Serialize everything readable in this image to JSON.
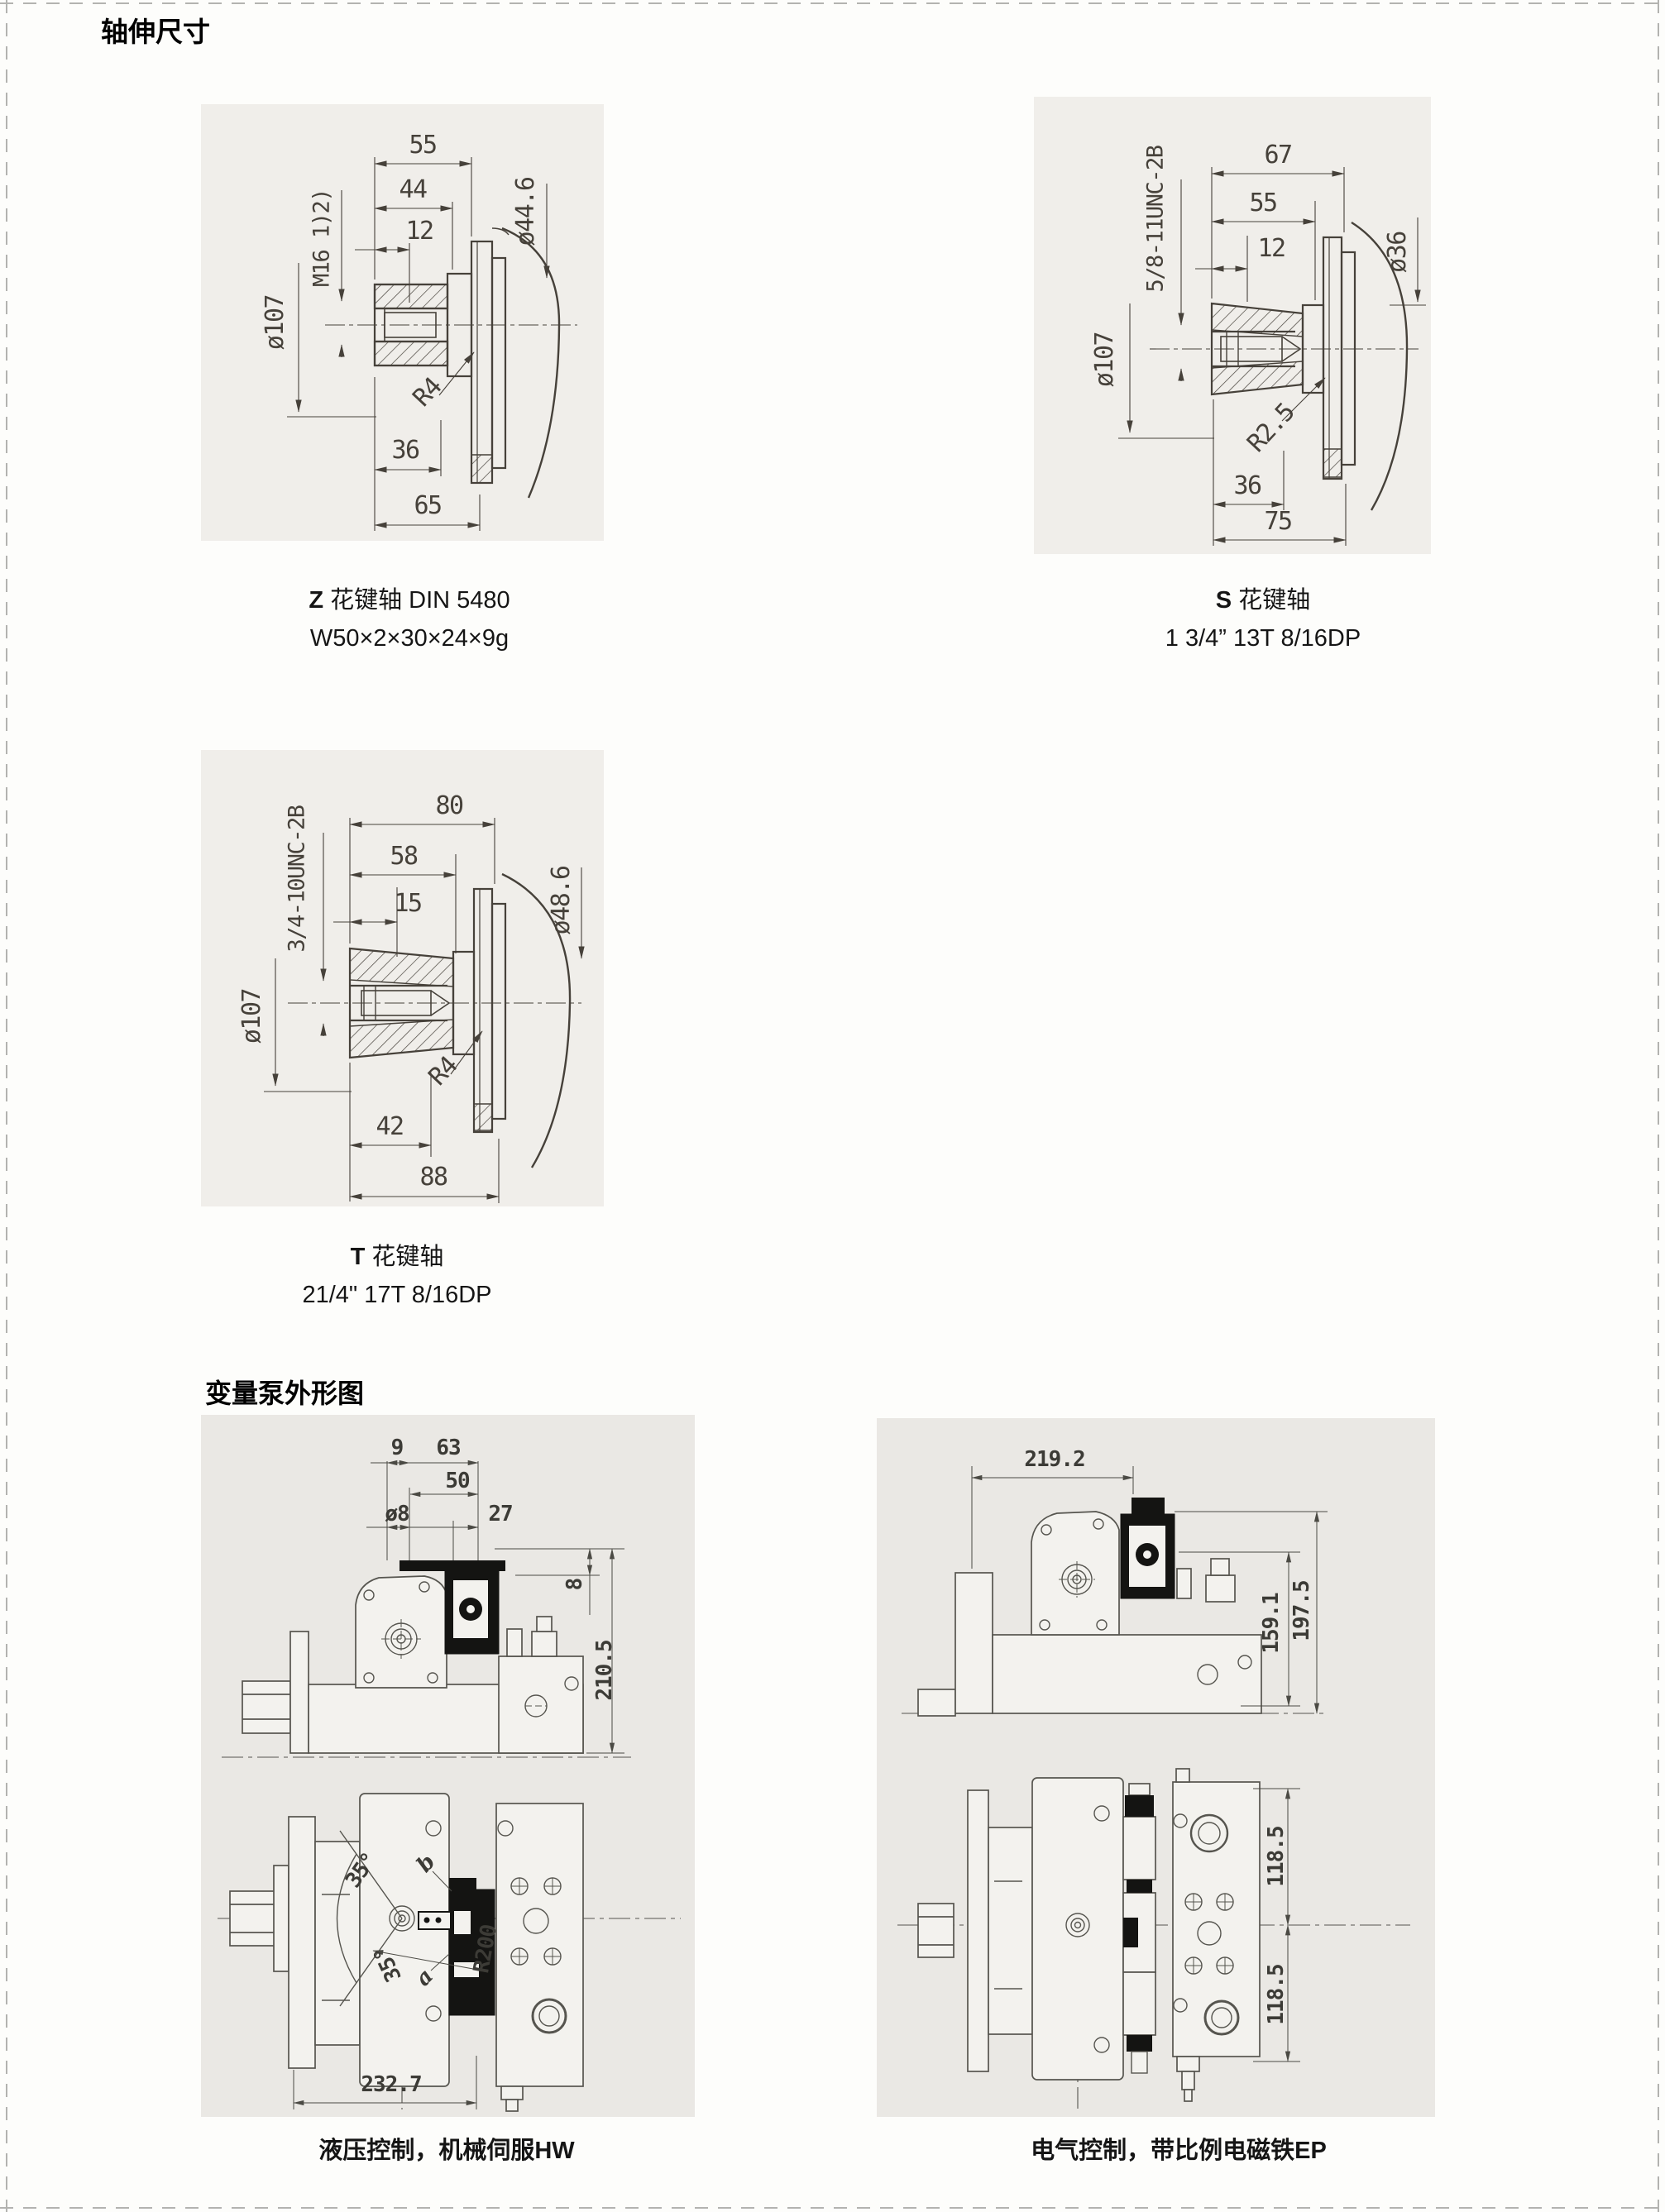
{
  "page": {
    "title": "轴伸尺寸",
    "section_pumps_title": "变量泵外形图"
  },
  "shaft_z": {
    "caption_prefix": "Z",
    "caption_name": "花键轴 DIN 5480",
    "caption_spec": "W50×2×30×24×9g",
    "dims": {
      "d55": "55",
      "d44": "44",
      "d12": "12",
      "thread": "M16 1)2)",
      "dia_right": "ø44.6",
      "dia_left": "ø107",
      "radius": "R4",
      "d36": "36",
      "d65": "65"
    }
  },
  "shaft_s": {
    "caption_prefix": "S",
    "caption_name": "花键轴",
    "caption_spec": "1 3/4”  13T 8/16DP",
    "dims": {
      "d67": "67",
      "d55": "55",
      "d12": "12",
      "thread": "5/8-11UNC-2B",
      "dia_right": "ø36",
      "dia_left": "ø107",
      "radius": "R2.5",
      "d36": "36",
      "d75": "75"
    }
  },
  "shaft_t": {
    "caption_prefix": "T",
    "caption_name": "花键轴",
    "caption_spec": "21/4\"  17T 8/16DP",
    "dims": {
      "d80": "80",
      "d58": "58",
      "d15": "15",
      "thread": "3/4-10UNC-2B",
      "dia_right": "ø48.6",
      "dia_left": "ø107",
      "radius": "R4",
      "d42": "42",
      "d88": "88"
    }
  },
  "pump_hw": {
    "caption": "液压控制，机械伺服HW",
    "dims": {
      "d9": "9",
      "d63": "63",
      "d50": "50",
      "dia8": "ø8",
      "d27": "27",
      "d8": "8",
      "d210": "210.5",
      "angle_top": "35°",
      "angle_bottom": "35°",
      "r200": "R200",
      "port_b": "b",
      "port_a": "a",
      "d232": "232.7"
    }
  },
  "pump_ep": {
    "caption": "电气控制，带比例电磁铁EP",
    "dims": {
      "d219": "219.2",
      "d159": "159.1",
      "d197": "197.5",
      "d118_top": "118.5",
      "d118_bottom": "118.5"
    }
  }
}
